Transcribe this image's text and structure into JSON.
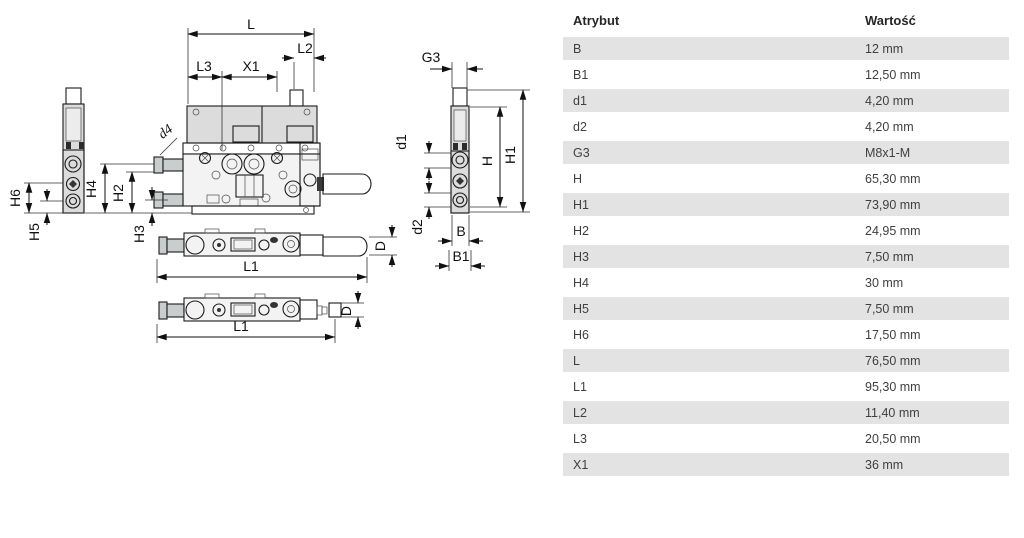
{
  "drawing": {
    "labels": {
      "L": "L",
      "L1": "L1",
      "L2": "L2",
      "L3": "L3",
      "X1": "X1",
      "d4": "d4",
      "H": "H",
      "H1": "H1",
      "H2": "H2",
      "H3": "H3",
      "H4": "H4",
      "H5": "H5",
      "H6": "H6",
      "G3": "G3",
      "d1": "d1",
      "d2": "d2",
      "B": "B",
      "B1": "B1",
      "D": "D"
    }
  },
  "table": {
    "headers": [
      "Atrybut",
      "Wartość"
    ],
    "rows": [
      [
        "B",
        "12 mm"
      ],
      [
        "B1",
        "12,50 mm"
      ],
      [
        "d1",
        "4,20 mm"
      ],
      [
        "d2",
        "4,20 mm"
      ],
      [
        "G3",
        "M8x1-M"
      ],
      [
        "H",
        "65,30 mm"
      ],
      [
        "H1",
        "73,90 mm"
      ],
      [
        "H2",
        "24,95 mm"
      ],
      [
        "H3",
        "7,50 mm"
      ],
      [
        "H4",
        "30 mm"
      ],
      [
        "H5",
        "7,50 mm"
      ],
      [
        "H6",
        "17,50 mm"
      ],
      [
        "L",
        "76,50 mm"
      ],
      [
        "L1",
        "95,30 mm"
      ],
      [
        "L2",
        "11,40 mm"
      ],
      [
        "L3",
        "20,50 mm"
      ],
      [
        "X1",
        "36 mm"
      ]
    ]
  },
  "colors": {
    "row_stripe": "#e3e3e3",
    "drawing_fill": "#dcdcdc",
    "line": "#1b1b1b"
  }
}
